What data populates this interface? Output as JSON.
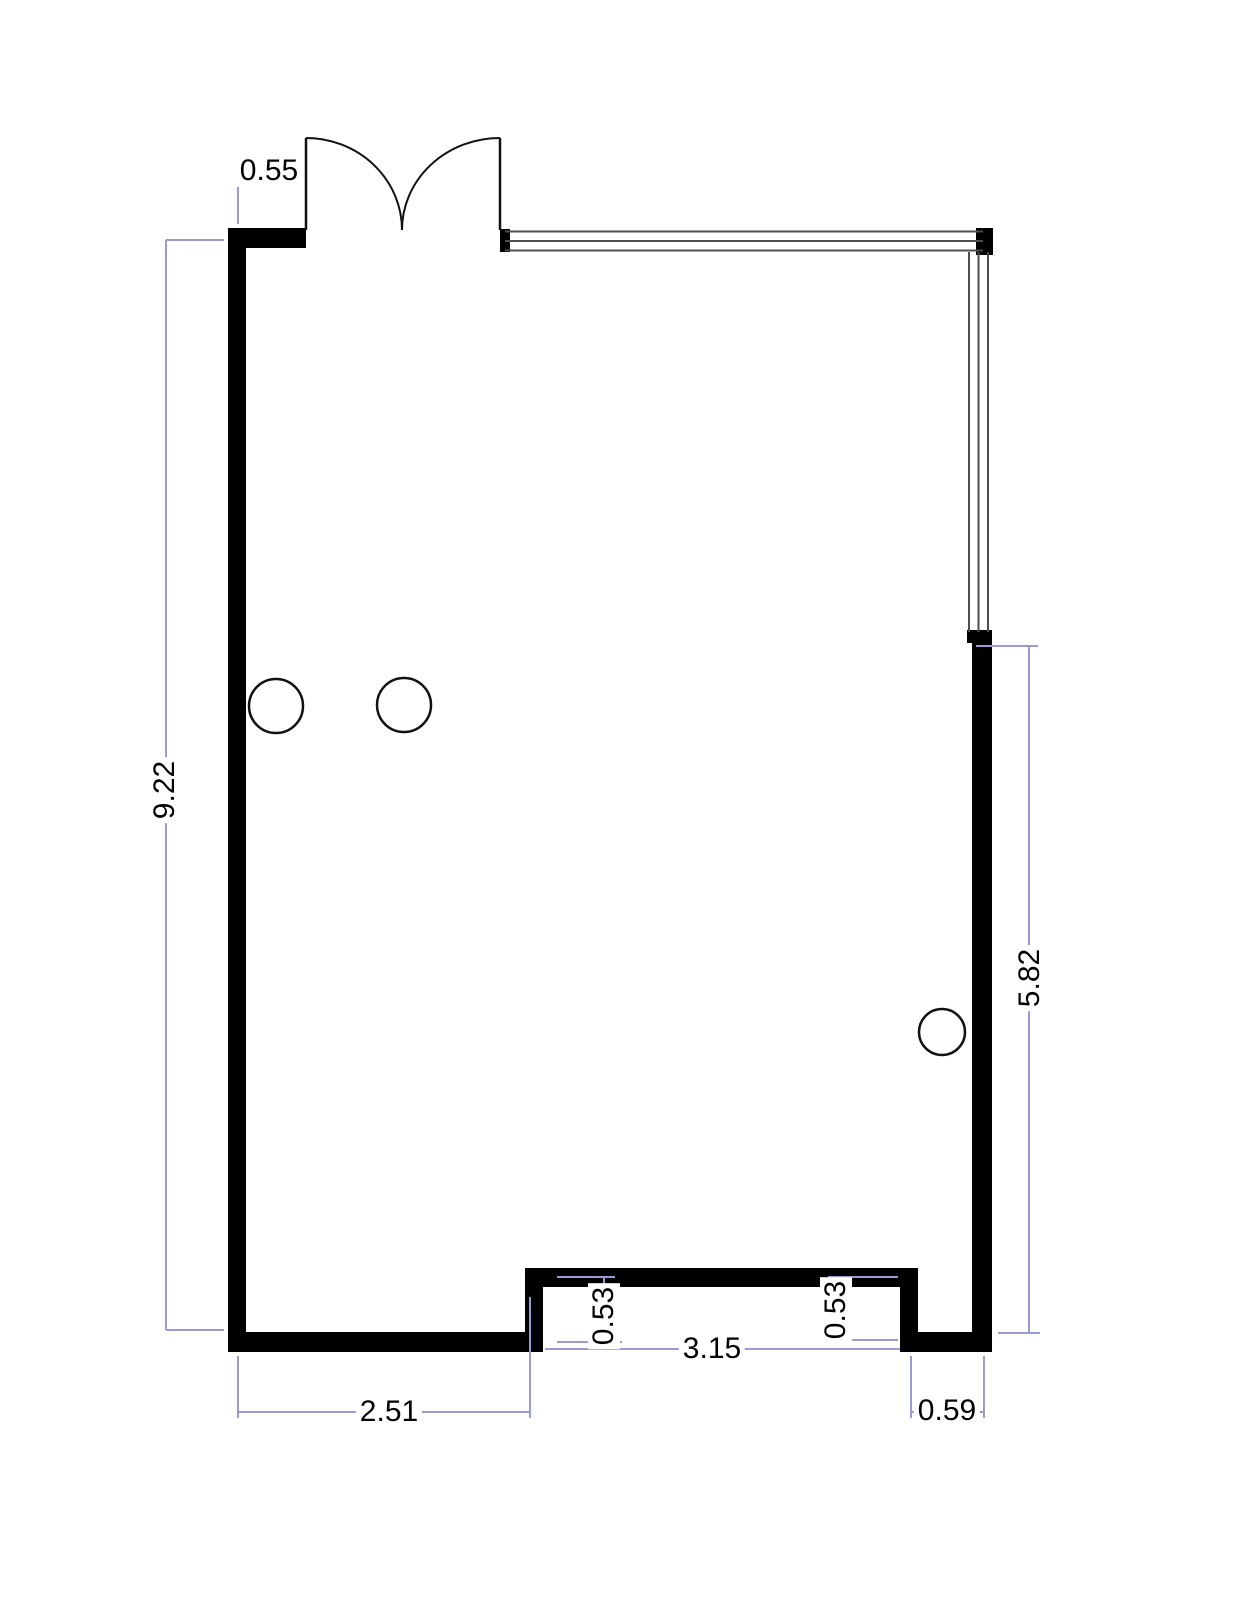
{
  "document": {
    "type": "floor-plan-drawing"
  },
  "colors": {
    "wall": "#000000",
    "glazing": "#4d4d4d",
    "dimension_line": "#9a9ad4",
    "dimension_text": "#000000",
    "background": "#ffffff"
  },
  "measurements": {
    "door_offset": "0.55",
    "left_side": "9.22",
    "right_side": "5.82",
    "bottom_left": "2.51",
    "opening_width": "3.15",
    "bottom_right": "0.59",
    "step_depth_left": "0.53",
    "step_depth_right": "0.53"
  },
  "symbols": {
    "door": "double-leaf-swing-door",
    "window_top": "window",
    "window_right": "window",
    "column_count": 3
  }
}
